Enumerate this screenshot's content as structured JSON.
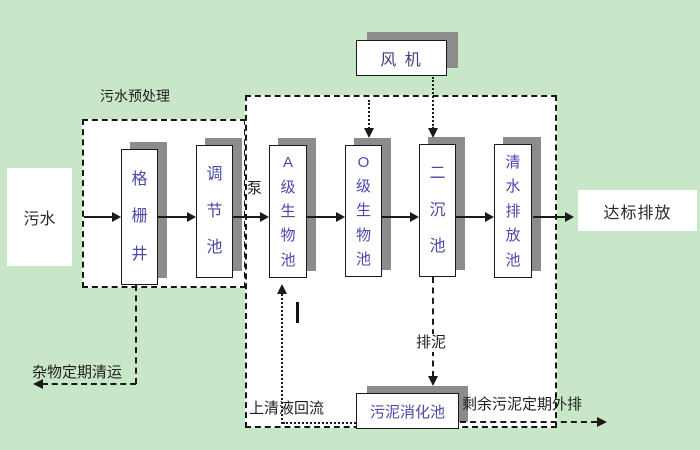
{
  "colors": {
    "background": "#c8e6c8",
    "box_fill": "#ffffff",
    "shadow": "#8c8c8c",
    "outline": "#1a1a1a",
    "tank_text": "#4949a8",
    "blower_text": "#3d3d78",
    "label_text": "#1f1f1f"
  },
  "labels": {
    "influent": "污水",
    "pretreatment_title": "污水预处理",
    "pump": "泵",
    "blower": "风 机",
    "effluent": "达标排放",
    "debris_removal": "杂物定期清运",
    "supernatant_return": "上清液回流",
    "sludge_discharge": "排泥",
    "excess_sludge_out": "剩余污泥定期外排"
  },
  "tanks": {
    "grid_well": "格栅井",
    "regulating": "调节池",
    "a_bio": "A级生物池",
    "o_bio": "O级生物池",
    "secondary_sedimentation": "二沉池",
    "clear_water_discharge": "清水排放池",
    "sludge_digestion": "污泥消化池"
  }
}
